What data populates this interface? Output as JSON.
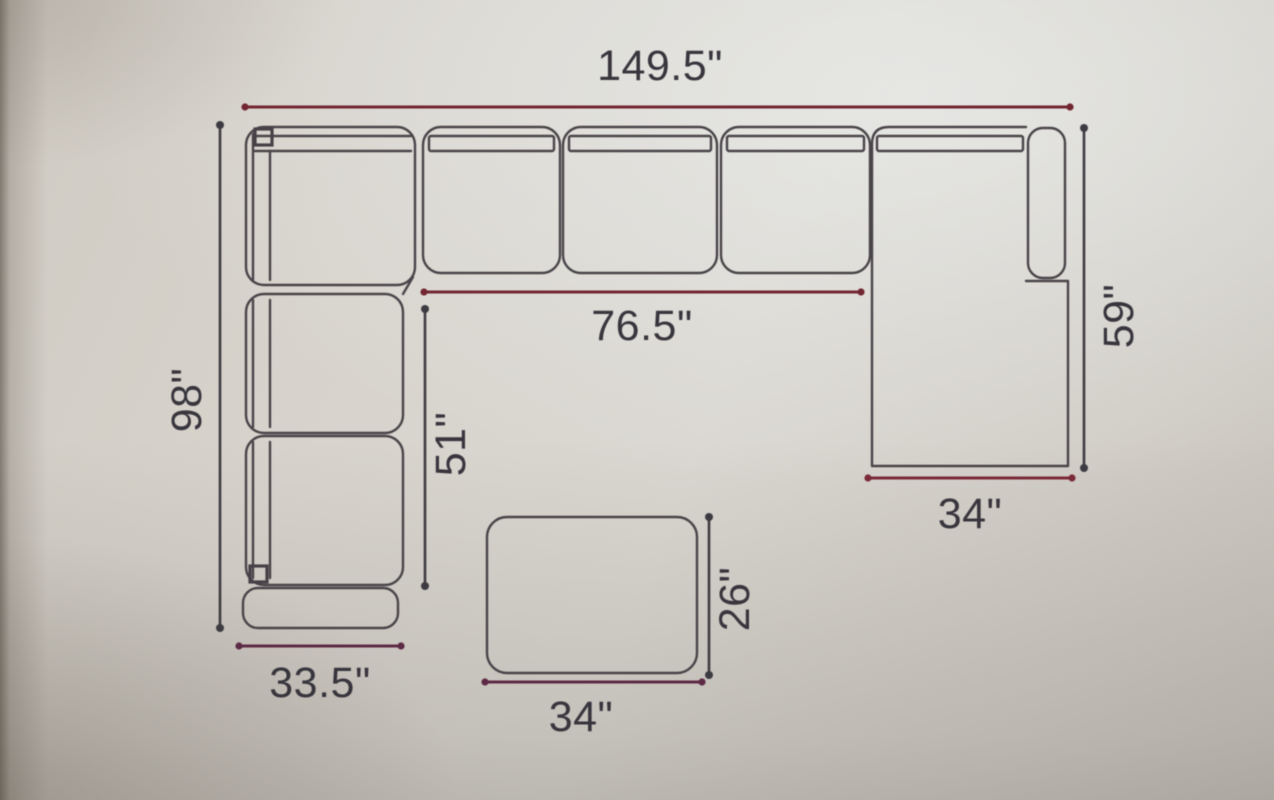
{
  "figure": {
    "kind": "sectional-sofa-floor-plan-with-ottoman",
    "units": "inches",
    "labels": {
      "overall_width": "149.5\"",
      "overall_depth": "98\"",
      "seat_run_width": "76.5\"",
      "seat_run_depth": "51\"",
      "chaise_length": "59\"",
      "chaise_width": "34\"",
      "left_section_width": "33.5\"",
      "ottoman_width": "34\"",
      "ottoman_depth": "26\""
    },
    "colors": {
      "outline": "#4a4549",
      "dim_dark": "#3e3a42",
      "dim_red": "#722733",
      "dim_purple": "#5d2b44",
      "text": "#39353d",
      "paper": "#d5d1ca"
    }
  }
}
